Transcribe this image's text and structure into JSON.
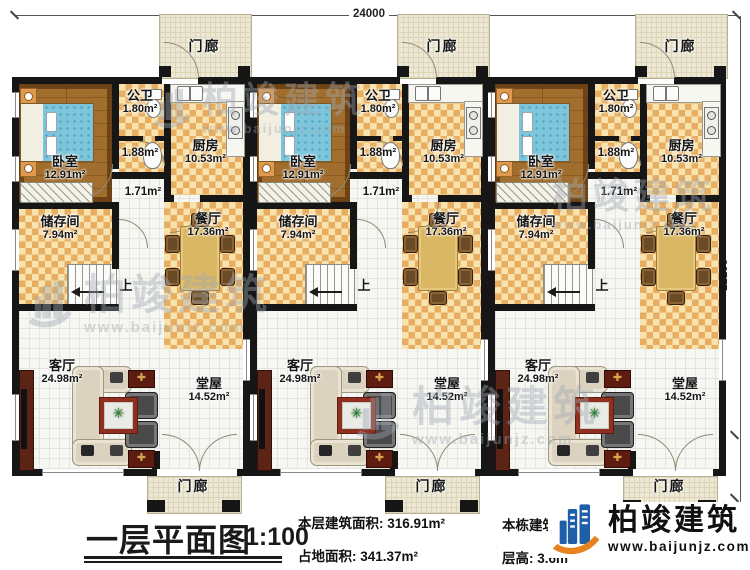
{
  "dimensions": {
    "top": "24000",
    "right": "12100",
    "right_bottom": "1000, 1200"
  },
  "watermark": {
    "brand": "柏竣建筑",
    "url": "www.baijunjz.com"
  },
  "unit": {
    "porch_top": "门廊",
    "porch_bottom": "门廊",
    "bathroom_name": "公卫",
    "bathroom_area": "1.80m²",
    "corridor_a_area": "1.88m²",
    "corridor_b_area": "1.71m²",
    "kitchen_name": "厨房",
    "kitchen_area": "10.53m²",
    "bedroom_name": "卧室",
    "bedroom_area": "12.91m²",
    "storage_name": "储存间",
    "storage_area": "7.94m²",
    "dining_name": "餐厅",
    "dining_area": "17.36m²",
    "stairs_up": "上",
    "living_name": "客厅",
    "living_area": "24.98m²",
    "hall_name": "堂屋",
    "hall_area": "14.52m²"
  },
  "footer": {
    "title": "一层平面图",
    "scale": "1:100",
    "stats": [
      {
        "label": "本层建筑面积:",
        "value": "316.91m²"
      },
      {
        "label": "占地面积:",
        "value": "341.37m²"
      },
      {
        "label": "本栋建筑面积:",
        "value": ""
      },
      {
        "label": "层高:",
        "value": "3.6m"
      }
    ],
    "logo_brand": "柏竣建筑",
    "logo_url": "www.baijunjz.com"
  },
  "colors": {
    "wall": "#161616",
    "checker_dark": "#e7ae61",
    "checker_light": "#f8e2ae",
    "wood": "#a26e2e",
    "porch": "#ece8d4",
    "logo_blue": "#1e5fa8",
    "logo_orange": "#e8821e"
  }
}
